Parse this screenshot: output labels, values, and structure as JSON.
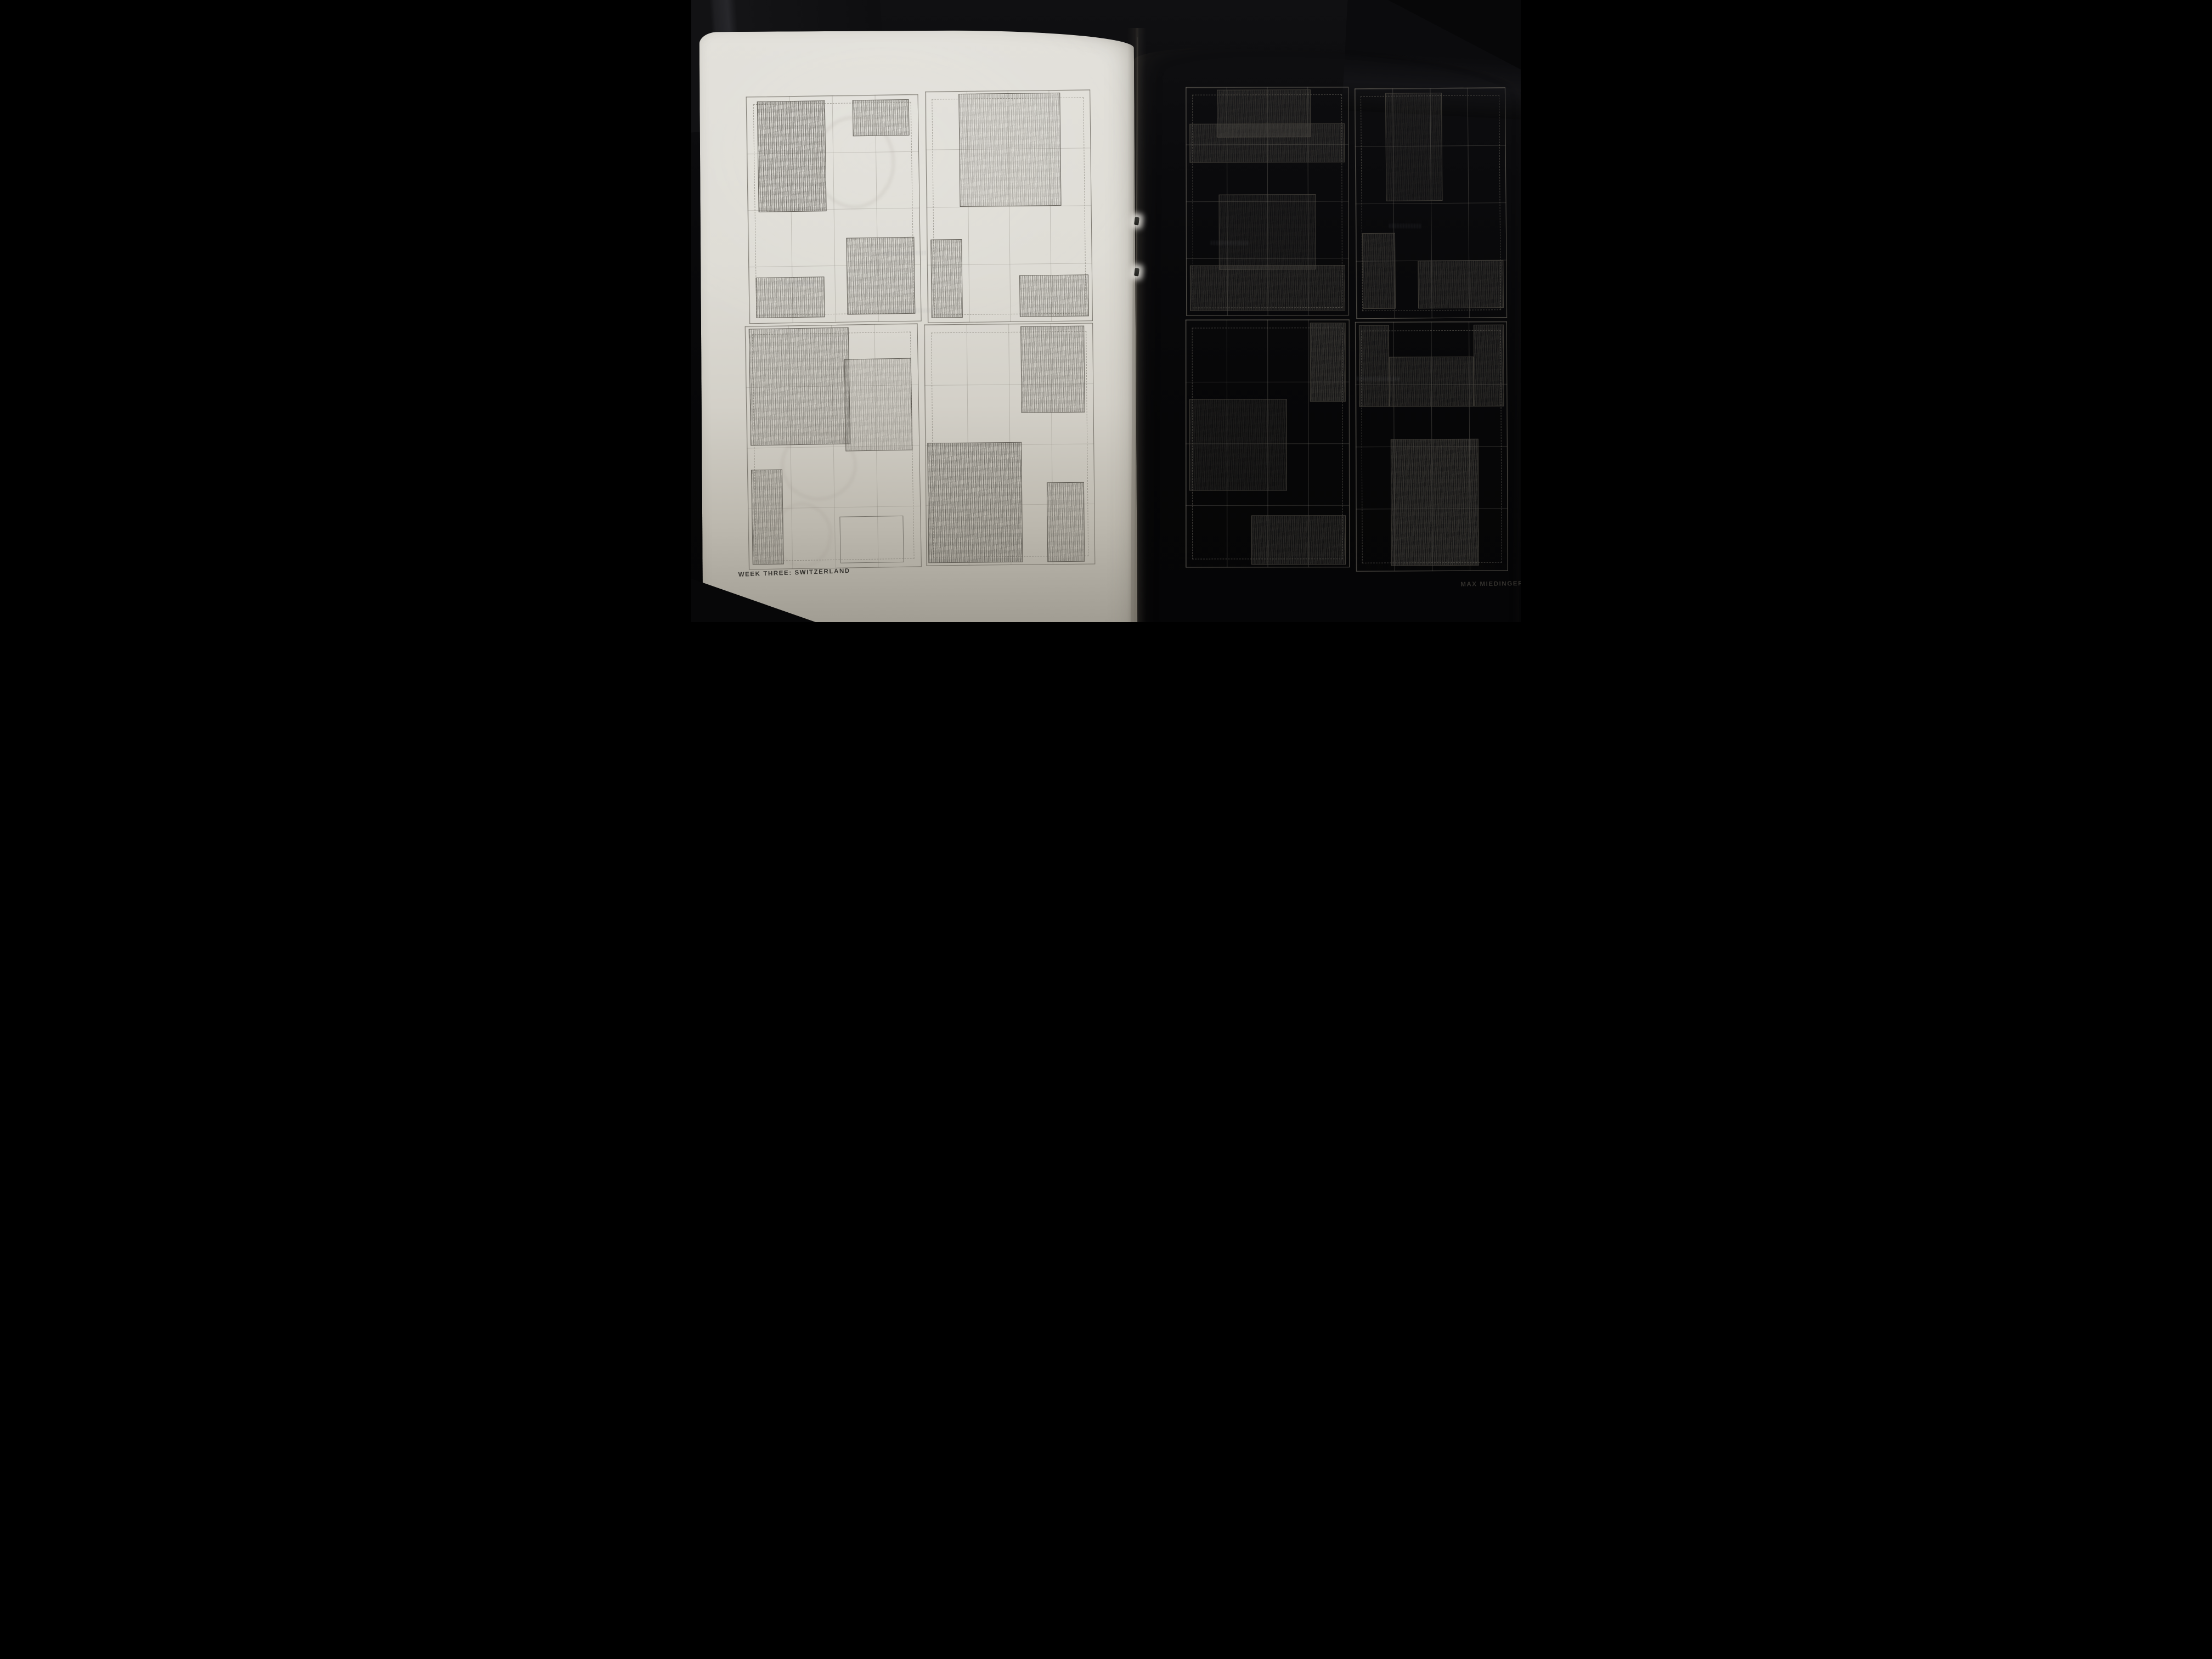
{
  "photo": {
    "subject": "open saddle-stitched sketchbook spread with pencil layout thumbnails",
    "background_color": "#0a0a0c",
    "paper_color": "#dedcd5",
    "pencil_color": "#6e6b64",
    "caption_color": "#33312d",
    "staple_count": 2
  },
  "footer": {
    "left": "WEEK THREE: SWITZERLAND",
    "right": "MAX MIEDINGER"
  },
  "pages": [
    {
      "side": "left",
      "caption": "WEEK THREE: SWITZERLAND",
      "thumbnails": [
        {
          "name": "sketch-1",
          "left": 10.8,
          "top": 10.6,
          "w": 39.6,
          "h": 37.6,
          "rot": -0.5,
          "blocks": [
            {
              "x": 6,
              "y": 2,
              "w": 40,
              "h": 49,
              "tone": "dark"
            },
            {
              "x": 62,
              "y": 2,
              "w": 33,
              "h": 16,
              "tone": "mid"
            },
            {
              "x": 57,
              "y": 63,
              "w": 40,
              "h": 34,
              "tone": "mid"
            },
            {
              "x": 4,
              "y": 80,
              "w": 40,
              "h": 18,
              "tone": "mid"
            }
          ]
        },
        {
          "name": "sketch-2",
          "left": 52.0,
          "top": 10.0,
          "w": 38.0,
          "h": 38.4,
          "rot": -0.3,
          "blocks": [
            {
              "x": 20,
              "y": 1,
              "w": 62,
              "h": 49,
              "tone": "light"
            },
            {
              "x": 2,
              "y": 64,
              "w": 19,
              "h": 34,
              "tone": "mid"
            },
            {
              "x": 56,
              "y": 80,
              "w": 42,
              "h": 18,
              "tone": "mid"
            }
          ]
        },
        {
          "name": "sketch-3",
          "left": 10.4,
          "top": 48.6,
          "w": 39.8,
          "h": 40.4,
          "rot": -0.6,
          "blocks": [
            {
              "x": 2,
              "y": 1,
              "w": 58,
              "h": 48,
              "tone": "mid"
            },
            {
              "x": 57,
              "y": 14,
              "w": 39,
              "h": 38,
              "tone": "light"
            },
            {
              "x": 2,
              "y": 59,
              "w": 18,
              "h": 39,
              "tone": "mid"
            },
            {
              "x": 53,
              "y": 79,
              "w": 37,
              "h": 19,
              "tone": "outline"
            }
          ]
        },
        {
          "name": "sketch-4",
          "left": 51.4,
          "top": 48.6,
          "w": 38.9,
          "h": 40.0,
          "rot": -0.2,
          "blocks": [
            {
              "x": 57,
              "y": 1,
              "w": 38,
              "h": 36,
              "tone": "mid"
            },
            {
              "x": 1,
              "y": 49,
              "w": 56,
              "h": 50,
              "tone": "dark"
            },
            {
              "x": 72,
              "y": 66,
              "w": 22,
              "h": 33,
              "tone": "mid"
            }
          ]
        }
      ]
    },
    {
      "side": "right",
      "caption": "MAX MIEDINGER",
      "thumbnails": [
        {
          "name": "sketch-5",
          "left": 13.6,
          "top": 6.8,
          "w": 42.0,
          "h": 38.9,
          "rot": -0.5,
          "blocks": [
            {
              "x": 19,
              "y": 1,
              "w": 58,
              "h": 21,
              "tone": "mid"
            },
            {
              "x": 2,
              "y": 16,
              "w": 96,
              "h": 17,
              "tone": "mid"
            },
            {
              "x": 20,
              "y": 47,
              "w": 60,
              "h": 33,
              "tone": "light"
            },
            {
              "x": 2,
              "y": 78,
              "w": 96,
              "h": 20,
              "tone": "mid"
            }
          ]
        },
        {
          "name": "sketch-6",
          "left": 57.3,
          "top": 6.8,
          "w": 38.9,
          "h": 39.2,
          "rot": -0.8,
          "blocks": [
            {
              "x": 20,
              "y": 2,
              "w": 38,
              "h": 47,
              "tone": "light"
            },
            {
              "x": 4,
              "y": 63,
              "w": 22,
              "h": 33,
              "tone": "mid"
            },
            {
              "x": 41,
              "y": 75,
              "w": 57,
              "h": 21,
              "tone": "mid"
            }
          ]
        },
        {
          "name": "sketch-7",
          "left": 13.9,
          "top": 46.4,
          "w": 42.3,
          "h": 42.2,
          "rot": -0.4,
          "blocks": [
            {
              "x": 76,
              "y": 1,
              "w": 22,
              "h": 32,
              "tone": "dark"
            },
            {
              "x": 2,
              "y": 32,
              "w": 60,
              "h": 37,
              "tone": "light"
            },
            {
              "x": 40,
              "y": 79,
              "w": 58,
              "h": 20,
              "tone": "mid"
            }
          ]
        },
        {
          "name": "sketch-8",
          "left": 57.7,
          "top": 46.6,
          "w": 39.2,
          "h": 42.5,
          "rot": -0.6,
          "blocks": [
            {
              "x": 2,
              "y": 1,
              "w": 20,
              "h": 33,
              "tone": "mid"
            },
            {
              "x": 22,
              "y": 14,
              "w": 56,
              "h": 20,
              "tone": "mid"
            },
            {
              "x": 78,
              "y": 1,
              "w": 20,
              "h": 33,
              "tone": "mid"
            },
            {
              "x": 23,
              "y": 47,
              "w": 58,
              "h": 51,
              "tone": "dark"
            }
          ]
        }
      ]
    }
  ]
}
